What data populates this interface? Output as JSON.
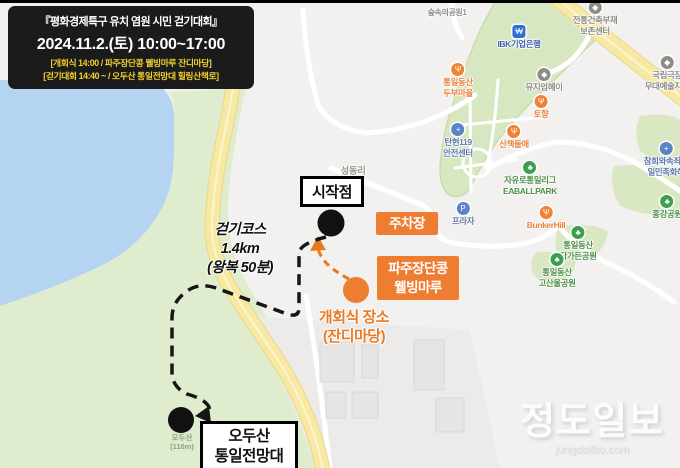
{
  "colors": {
    "land": "#f2f1ef",
    "water": "#b5d4f1",
    "hill": "#dfecce",
    "golf": "#d7e7c2",
    "patch": "#d9e8c2",
    "road-yellow": "#f7e8a2",
    "road-yellow-edge": "#ead789",
    "road-yellow-center": "#fcf4d2",
    "building": "#e6e5e3",
    "orange": "#ed7d31",
    "orange-text": "#e87a24",
    "header-bg": "#1b1b1b",
    "header-accent": "#f2d32e"
  },
  "header": {
    "line1": "『평화경제특구 유치 염원 시민 걷기대회』",
    "line2": "2024.11.2.(토) 10:00~17:00",
    "line3": "[개회식 14:00  /  파주장단콩 웰빙마루 잔디마당]",
    "line4": "[걷기대회 14:40 ~ / 오두산 통일전망대 힐링산책로]"
  },
  "annotations": {
    "start_label": "시작점",
    "parking_label": "주차장",
    "wellbeing_line1": "파주장단콩",
    "wellbeing_line2": "웰빙마루",
    "ceremony_line1": "개회식 장소",
    "ceremony_line2": "(잔디마당)",
    "course_line1": "걷기코스",
    "course_line2": "1.4km",
    "course_line3": "(왕복 50분)",
    "observatory_line1": "오두산",
    "observatory_line2": "통일전망대",
    "mountain_name": "오두산",
    "mountain_elev": "(110m)"
  },
  "map": {
    "pois": [
      {
        "id": "forest-park",
        "x": 447,
        "y": 8,
        "color": "#8f8f89",
        "size": 8,
        "icon": null,
        "lines": [
          "숲속의공원1"
        ]
      },
      {
        "id": "ibk-bank",
        "x": 519,
        "y": 25,
        "color": "#3f62b0",
        "icon": {
          "name": "bank-icon",
          "bg": "#2f6fd6",
          "glyph": "₩",
          "square": true
        },
        "lines": [
          "IBK기업은행"
        ]
      },
      {
        "id": "heritage-center",
        "x": 595,
        "y": 1,
        "color": "#8b8b85",
        "icon": {
          "name": "museum-icon",
          "bg": "#8d8d88",
          "glyph": "◆"
        },
        "lines": [
          "전통건축부재",
          "보존센터"
        ]
      },
      {
        "id": "national-theater",
        "x": 667,
        "y": 56,
        "color": "#8b8b85",
        "icon": {
          "name": "theater-icon",
          "bg": "#8d8d88",
          "glyph": "◆"
        },
        "lines": [
          "국립극장",
          "무대예술지원"
        ]
      },
      {
        "id": "tofu-village",
        "x": 458,
        "y": 63,
        "color": "#e8823c",
        "icon": {
          "name": "restaurant-icon",
          "bg": "#ef8234",
          "glyph": "Ψ"
        },
        "lines": [
          "통일동산",
          "두부마을"
        ]
      },
      {
        "id": "museum-hey",
        "x": 544,
        "y": 68,
        "color": "#8b8b85",
        "icon": {
          "name": "museum-icon",
          "bg": "#8d8d88",
          "glyph": "◆"
        },
        "lines": [
          "뮤지엄헤이"
        ]
      },
      {
        "id": "tohyang",
        "x": 541,
        "y": 95,
        "color": "#e8823c",
        "icon": {
          "name": "restaurant-icon",
          "bg": "#ef8234",
          "glyph": "Ψ"
        },
        "lines": [
          "토향"
        ]
      },
      {
        "id": "fire-station-119",
        "x": 458,
        "y": 123,
        "color": "#5d77ab",
        "icon": {
          "name": "fire-station-icon",
          "bg": "#5c82c8",
          "glyph": "+"
        },
        "lines": [
          "탄현119",
          "안전센터"
        ]
      },
      {
        "id": "sanchaek",
        "x": 514,
        "y": 125,
        "color": "#e8823c",
        "icon": {
          "name": "restaurant-icon",
          "bg": "#ef8234",
          "glyph": "Ψ"
        },
        "lines": [
          "산책들애"
        ]
      },
      {
        "id": "eaballpark",
        "x": 530,
        "y": 161,
        "color": "#4f8f49",
        "icon": {
          "name": "park-icon",
          "bg": "#3f9e4f",
          "glyph": "♣"
        },
        "lines": [
          "자유로통일리그",
          "EABALLPARK"
        ]
      },
      {
        "id": "atonement-church",
        "x": 666,
        "y": 142,
        "color": "#5d77ab",
        "icon": {
          "name": "church-icon",
          "bg": "#5c82c8",
          "glyph": "+"
        },
        "lines": [
          "참회와속죄의",
          "일민족화해"
        ]
      },
      {
        "id": "heunggang-park",
        "x": 667,
        "y": 195,
        "color": "#4f8f49",
        "icon": {
          "name": "park-icon",
          "bg": "#3f9e4f",
          "glyph": "♣"
        },
        "lines": [
          "흥강공원"
        ]
      },
      {
        "id": "bunker-hill",
        "x": 546,
        "y": 206,
        "color": "#e8823c",
        "icon": {
          "name": "restaurant-icon",
          "bg": "#ef8234",
          "glyph": "Ψ"
        },
        "lines": [
          "BunkerHill"
        ]
      },
      {
        "id": "jakga-park",
        "x": 578,
        "y": 226,
        "color": "#4f8f49",
        "icon": {
          "name": "park-icon",
          "bg": "#3f9e4f",
          "glyph": "♣"
        },
        "lines": [
          "통일동산",
          "작가든공원"
        ]
      },
      {
        "id": "gosanul-park",
        "x": 557,
        "y": 253,
        "color": "#4f8f49",
        "icon": {
          "name": "park-icon",
          "bg": "#3f9e4f",
          "glyph": "♣"
        },
        "lines": [
          "통일동산",
          "고산울공원"
        ]
      },
      {
        "id": "seongdong-ri",
        "x": 353,
        "y": 166,
        "color": "#9a9a93",
        "size": 9.5,
        "icon": null,
        "lines": [
          "성동리"
        ]
      },
      {
        "id": "plaza",
        "x": 463,
        "y": 202,
        "color": "#5d77ab",
        "icon": {
          "name": "plaza-icon",
          "bg": "#5c82c8",
          "glyph": "P"
        },
        "lines": [
          "프라자"
        ]
      }
    ]
  },
  "watermark": {
    "title": "정도일보",
    "url": "jungdoilbo.com"
  }
}
